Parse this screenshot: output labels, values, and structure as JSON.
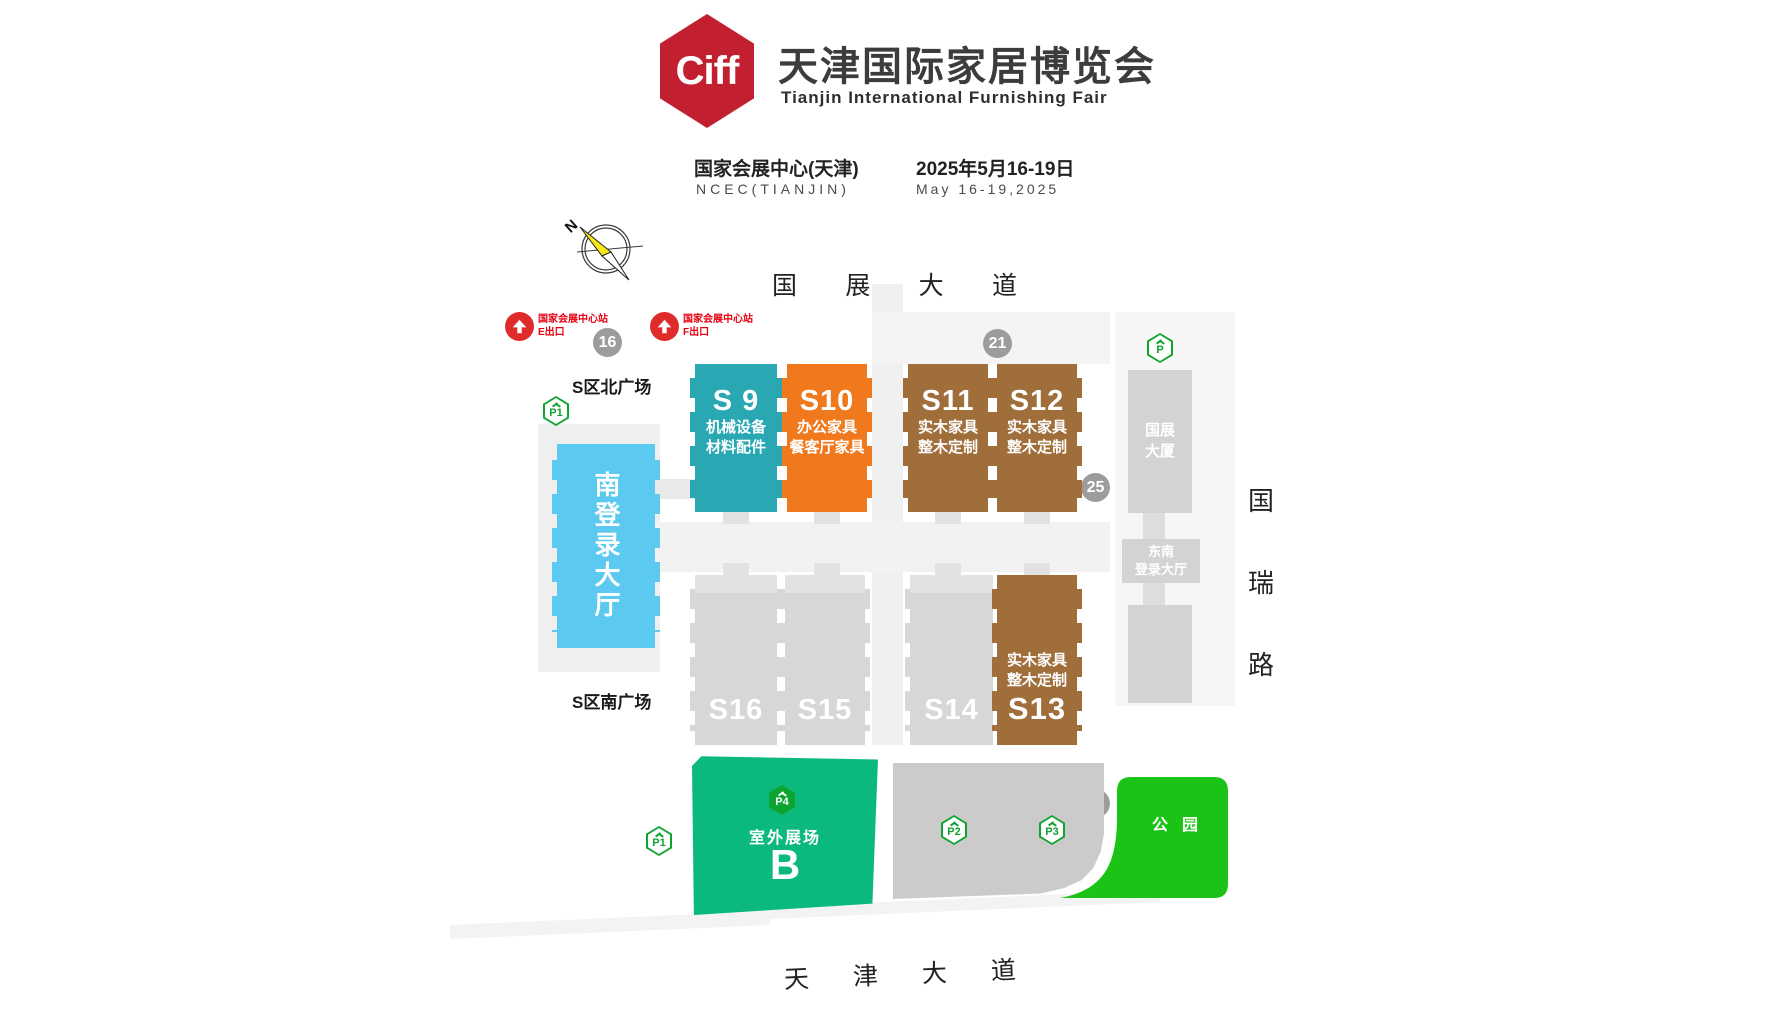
{
  "header": {
    "logo": "Ciff",
    "title_zh": "天津国际家居博览会",
    "title_en": "Tianjin International Furnishing Fair",
    "venue_zh": "国家会展中心(天津)",
    "venue_en": "NCEC(TIANJIN)",
    "date_zh": "2025年5月16-19日",
    "date_en": "May 16-19,2025"
  },
  "compass": {
    "north": "N"
  },
  "roads": {
    "north_chars": [
      "国",
      "展",
      "大",
      "道"
    ],
    "south_chars": [
      "天",
      "津",
      "大",
      "道"
    ],
    "east_chars": [
      "国",
      "瑞",
      "路"
    ]
  },
  "metro": {
    "station_e": {
      "name": "国家会展中心站",
      "exit": "E出口"
    },
    "station_f": {
      "name": "国家会展中心站",
      "exit": "F出口"
    }
  },
  "badges": {
    "b16": "16",
    "b21": "21",
    "b25": "25",
    "b29": "29"
  },
  "plazas": {
    "north": "S区北广场",
    "south": "S区南广场"
  },
  "lobbies": {
    "south_lobby": "南登录大厅",
    "expo_tower_lines": [
      "国展",
      "大厦"
    ],
    "southeast_lines": [
      "东南",
      "登录大厅"
    ]
  },
  "halls": {
    "top": [
      {
        "id": "S 9",
        "lines": [
          "机械设备",
          "材料配件"
        ],
        "color": "#29A7B3"
      },
      {
        "id": "S10",
        "lines": [
          "办公家具",
          "餐客厅家具"
        ],
        "color": "#F0791E"
      },
      {
        "id": "S11",
        "lines": [
          "实木家具",
          "整木定制"
        ],
        "color": "#A06E3A"
      },
      {
        "id": "S12",
        "lines": [
          "实木家具",
          "整木定制"
        ],
        "color": "#A06E3A"
      }
    ],
    "bottom": [
      {
        "id": "S16",
        "lines": [],
        "color": "#D7D7D7"
      },
      {
        "id": "S15",
        "lines": [],
        "color": "#D7D7D7"
      },
      {
        "id": "S14",
        "lines": [],
        "color": "#D7D7D7"
      },
      {
        "id": "S13",
        "lines": [
          "实木家具",
          "整木定制"
        ],
        "color": "#A06E3A"
      }
    ]
  },
  "south_zone": {
    "outdoor_label": "室外展场",
    "outdoor_letter": "B",
    "park_label": "公园"
  },
  "parking": {
    "p1_top": "P1",
    "p_right": "P",
    "p1_bottom": "P1",
    "p2": "P2",
    "p3": "P3",
    "p4": "P4"
  },
  "colors": {
    "ciff_red": "#C21F30",
    "metro_red": "#E02B2B",
    "metro_text_red": "#E60012",
    "hall_teal": "#29A7B3",
    "hall_orange": "#F0791E",
    "hall_brown": "#A06E3A",
    "hall_gray": "#D7D7D7",
    "lobby_blue": "#5CC9F1",
    "outdoor_green": "#0CB97D",
    "park_green": "#1CC317",
    "parking_green": "#0FA32F",
    "badge_gray": "#9C9C9C"
  }
}
